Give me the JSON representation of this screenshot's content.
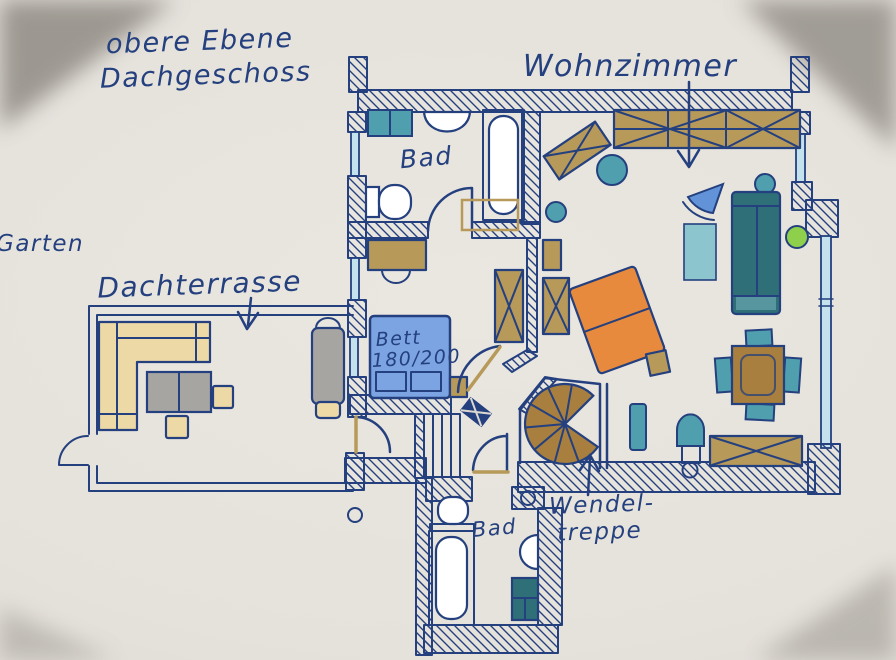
{
  "title": {
    "line1": "obere Ebene",
    "line2": "Dachgeschoss"
  },
  "labels": {
    "living_room": "Wohnzimmer",
    "garden": "Garten",
    "roof_terrace": "Dachterrasse",
    "bathroom_upper": "Bad",
    "bathroom_lower": "Bad",
    "bed_line1": "Bett",
    "bed_line2": "180/200",
    "spiral_staircase_line1": "Wendel-",
    "spiral_staircase_line2": "treppe"
  },
  "colors": {
    "ink": "#24407e",
    "paper": "#e7e3dd",
    "shadow": "#8a867f",
    "window-blue": "#c3e2ee",
    "tan": "#b7995a",
    "tan-light": "#ecd9a6",
    "brown": "#a87f3e",
    "teal": "#4f9fae",
    "teal-dark": "#2e6f78",
    "teal-light": "#8cc5ce",
    "bed-blue": "#7da4e2",
    "chair-blue": "#6292d8",
    "orange": "#e88a3d",
    "green": "#8ed04b",
    "gray": "#a7a5a2",
    "white": "#ffffff"
  }
}
